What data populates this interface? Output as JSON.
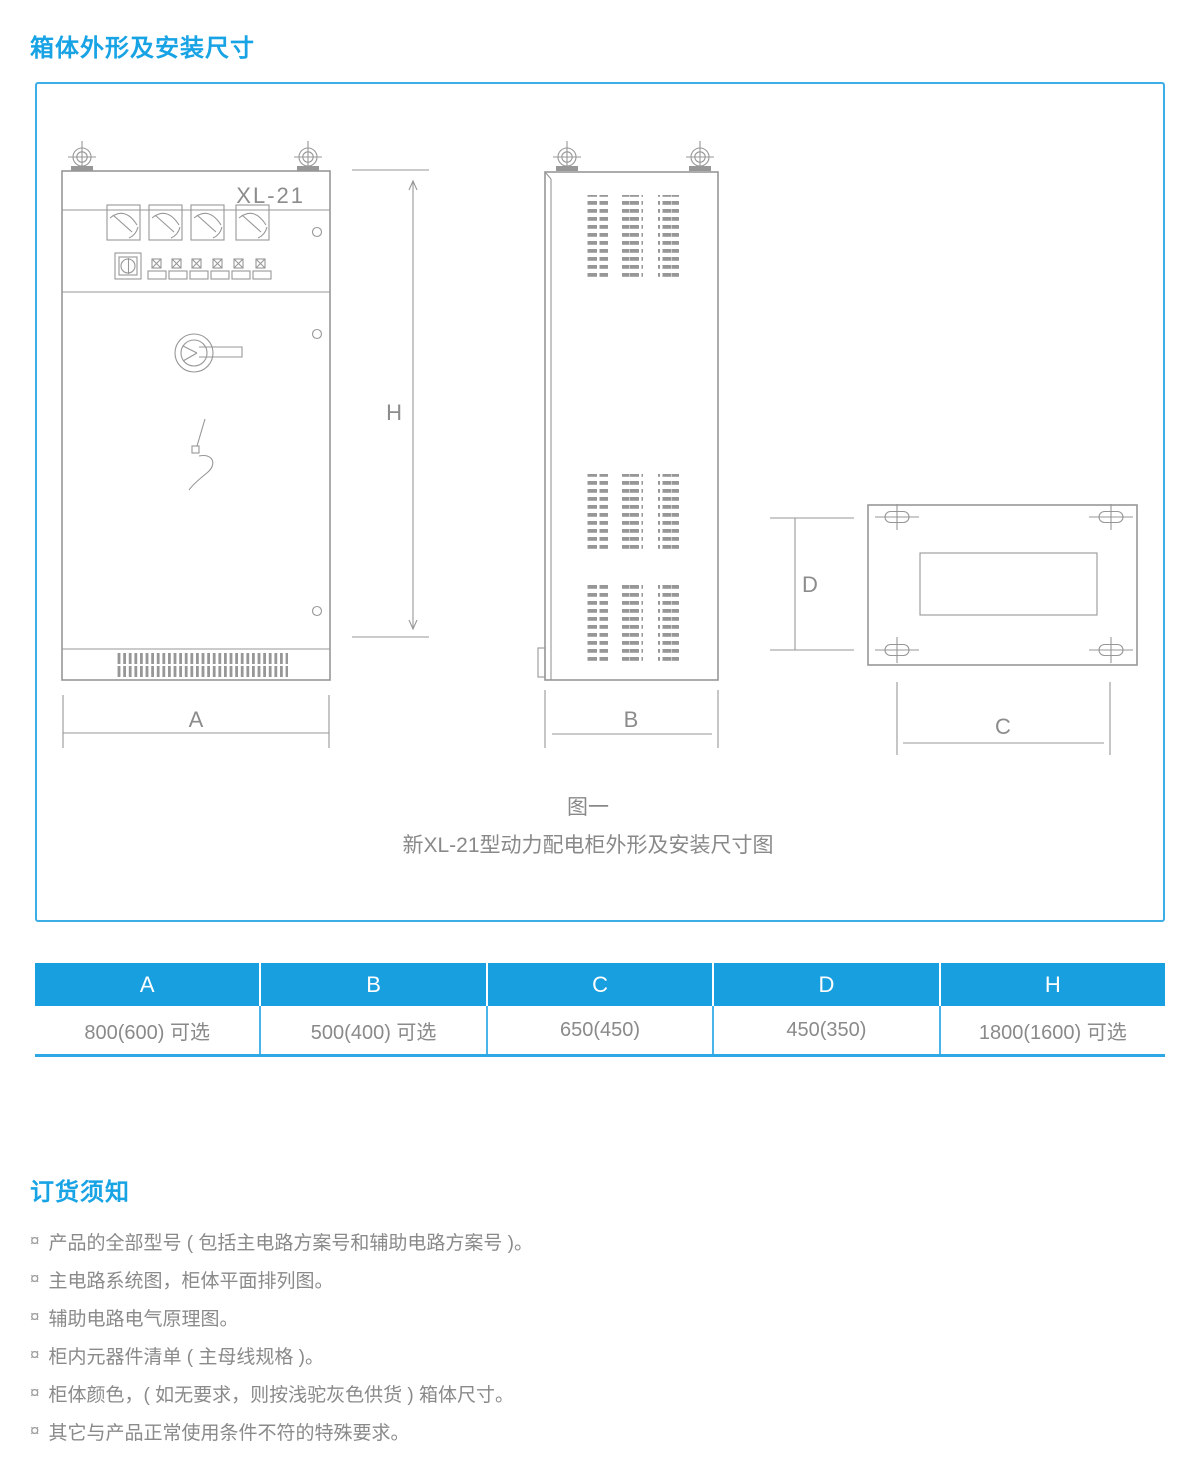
{
  "colors": {
    "accent": "#18a3e5",
    "table_header_bg": "#189fe0",
    "table_line": "#49b4e9",
    "table_line_strong": "#2ea8e4",
    "frame_border": "#3dade5",
    "text_gray": "#8a8a8a",
    "drawing": "#979797",
    "header_text": "#ffffff"
  },
  "sections": {
    "dimensions_title": "箱体外形及安装尺寸",
    "ordering_title": "订货须知"
  },
  "figure": {
    "cabinet_label": "XL-21",
    "dim_labels": {
      "A": "A",
      "B": "B",
      "C": "C",
      "D": "D",
      "H": "H"
    },
    "caption_line1": "图一",
    "caption_line2": "新XL-21型动力配电柜外形及安装尺寸图"
  },
  "table": {
    "headers": [
      "A",
      "B",
      "C",
      "D",
      "H"
    ],
    "values": [
      "800(600) 可选",
      "500(400) 可选",
      "650(450)",
      "450(350)",
      "1800(1600) 可选"
    ]
  },
  "notes": {
    "bullet": "¤",
    "items": [
      "产品的全部型号 ( 包括主电路方案号和辅助电路方案号 )。",
      "主电路系统图，柜体平面排列图。",
      "辅助电路电气原理图。",
      "柜内元器件清单 ( 主母线规格 )。",
      "柜体颜色，( 如无要求，则按浅驼灰色供货 ) 箱体尺寸。",
      "其它与产品正常使用条件不符的特殊要求。"
    ]
  }
}
